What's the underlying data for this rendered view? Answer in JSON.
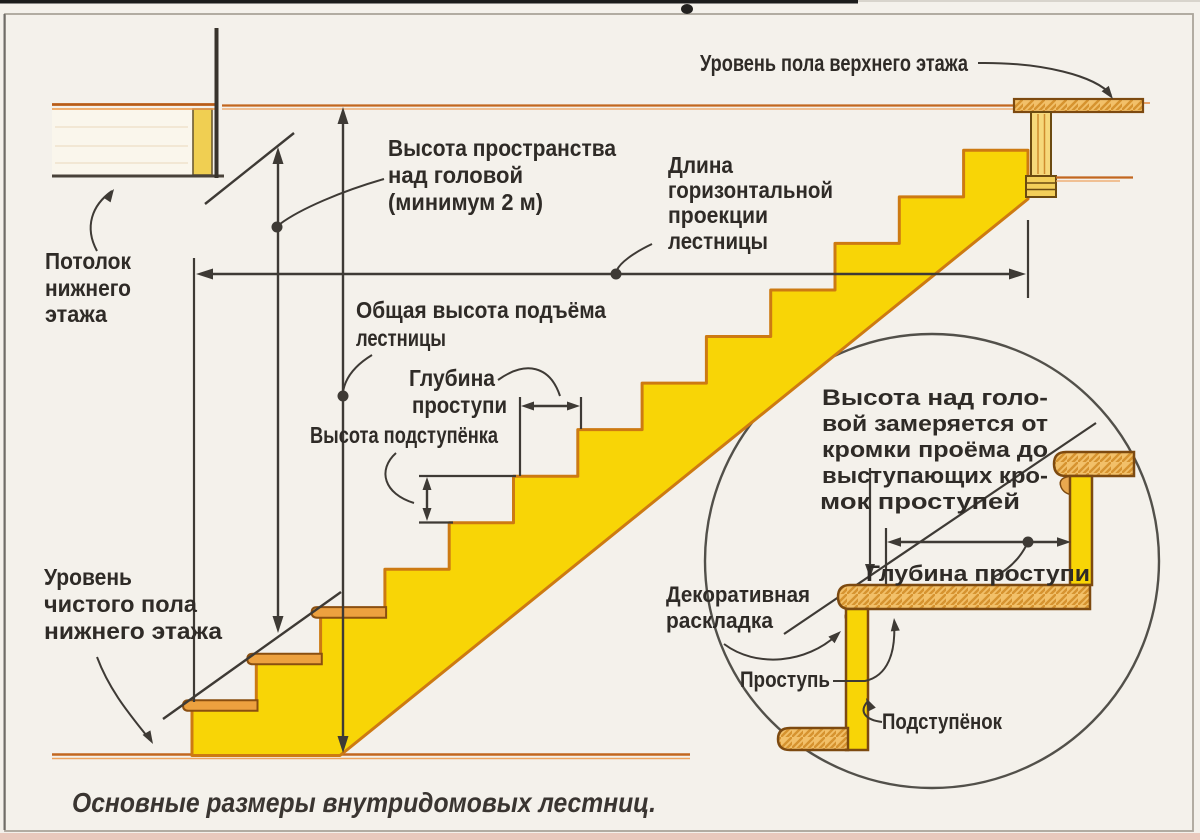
{
  "diagram": {
    "caption": "Основные размеры внутридомовых лестниц.",
    "labels": {
      "upper_floor_level": "Уровень пола верхнего этажа",
      "headroom_l1": "Высота пространства",
      "headroom_l2": "над головой",
      "headroom_l3": "(минимум 2 м)",
      "projection_l1": "Длина",
      "projection_l2": "горизонтальной",
      "projection_l3": "проекции",
      "projection_l4": "лестницы",
      "lower_ceiling_l1": "Потолок",
      "lower_ceiling_l2": "нижнего",
      "lower_ceiling_l3": "этажа",
      "total_rise_l1": "Общая высота подъёма",
      "total_rise_l2": "лестницы",
      "tread_depth_l1": "Глубина",
      "tread_depth_l2": "проступи",
      "riser_height": "Высота подступёнка",
      "lower_floor_l1": "Уровень",
      "lower_floor_l2": "чистого пола",
      "lower_floor_l3": "нижнего этажа"
    },
    "inset": {
      "note_l1": "Высота над голо-",
      "note_l2": "вой замеряется от",
      "note_l3": "кромки проёма до",
      "note_l4": "выступающих кро-",
      "note_l5": "мок проступей",
      "tread_depth": "Глубина проступи",
      "decorative_trim_l1": "Декоративная",
      "decorative_trim_l2": "раскладка",
      "tread": "Проступь",
      "riser": "Подступёнок"
    },
    "colors": {
      "stair_fill": "#f8d506",
      "stair_outline": "#cd7a12",
      "wood_fill": "#f2c069",
      "wood_dark": "#7d4a10",
      "floor_line": "#c2671f",
      "ink": "#3e3a35",
      "background": "#f4f1eb"
    }
  }
}
